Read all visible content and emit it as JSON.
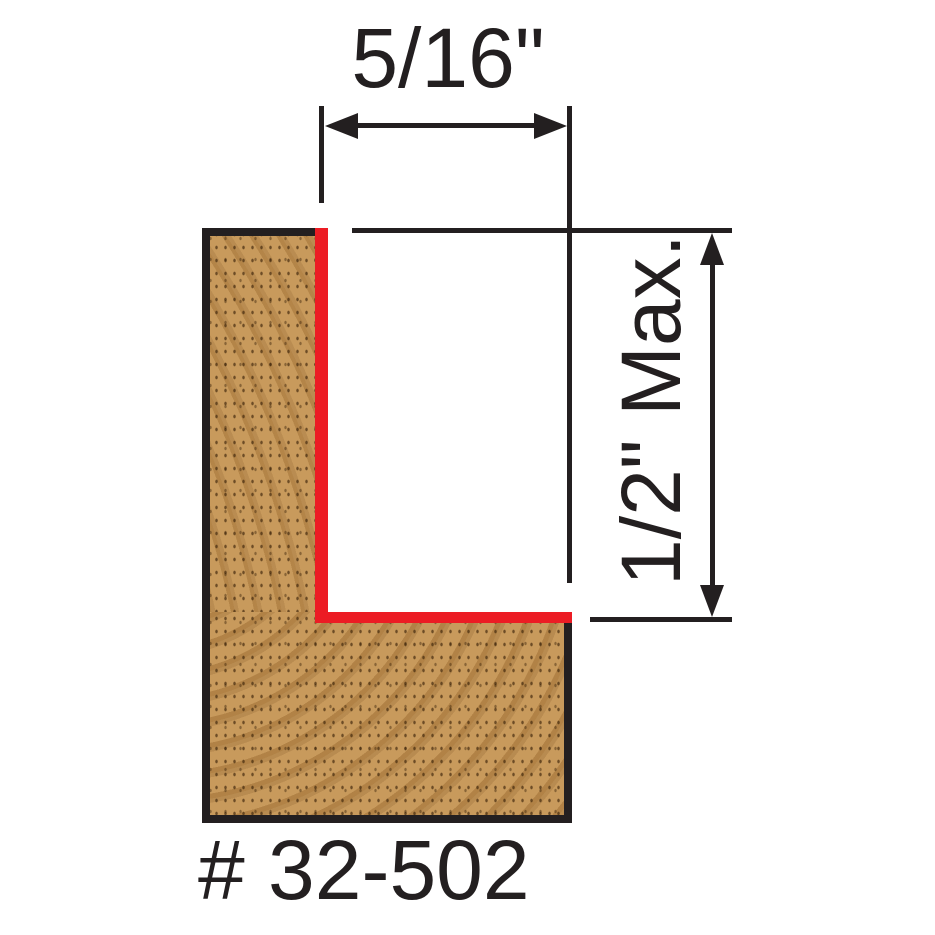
{
  "labels": {
    "width_dimension": "5/16\"",
    "depth_dimension": "1/2\" Max.",
    "part_number": "# 32-502"
  },
  "icons": {
    "width_arrow": "double-headed-horizontal-arrow",
    "depth_arrow": "double-headed-vertical-arrow"
  },
  "colors": {
    "ink": "#231f20",
    "red": "#ec1c24",
    "wood": "#c89a5c",
    "background": "#ffffff"
  }
}
